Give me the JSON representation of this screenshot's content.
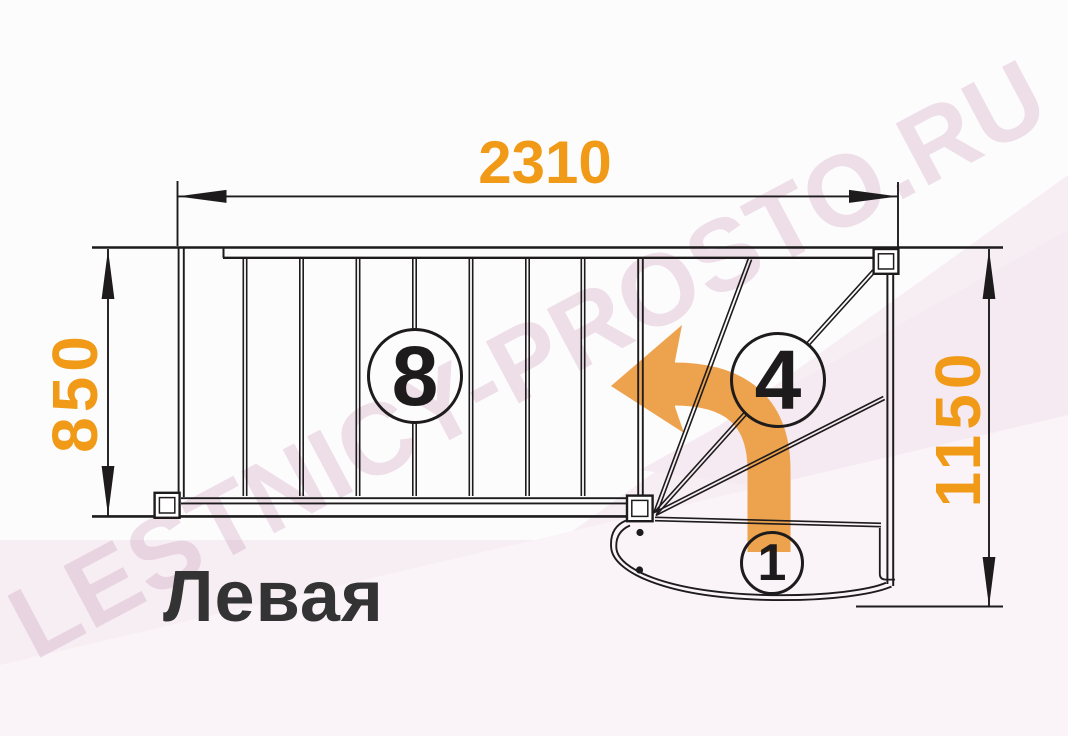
{
  "diagram": {
    "caption": "Левая",
    "watermark": "LESTNICY-PROSTO.RU",
    "dimensions": {
      "top": "2310",
      "left": "850",
      "right": "1150"
    },
    "steps": {
      "straight_flight_label": "8",
      "winder_label": "4",
      "first_step_label": "1"
    },
    "colors": {
      "line": "#1d1b1b",
      "dim": "#f09a18",
      "arrow": "#eda24e",
      "caption": "#333333",
      "watermark": "rgba(177,105,150,0.20)",
      "tint1": "#f7eef4",
      "tint2": "#f5eaf1",
      "tint3": "#faf3f8"
    }
  }
}
